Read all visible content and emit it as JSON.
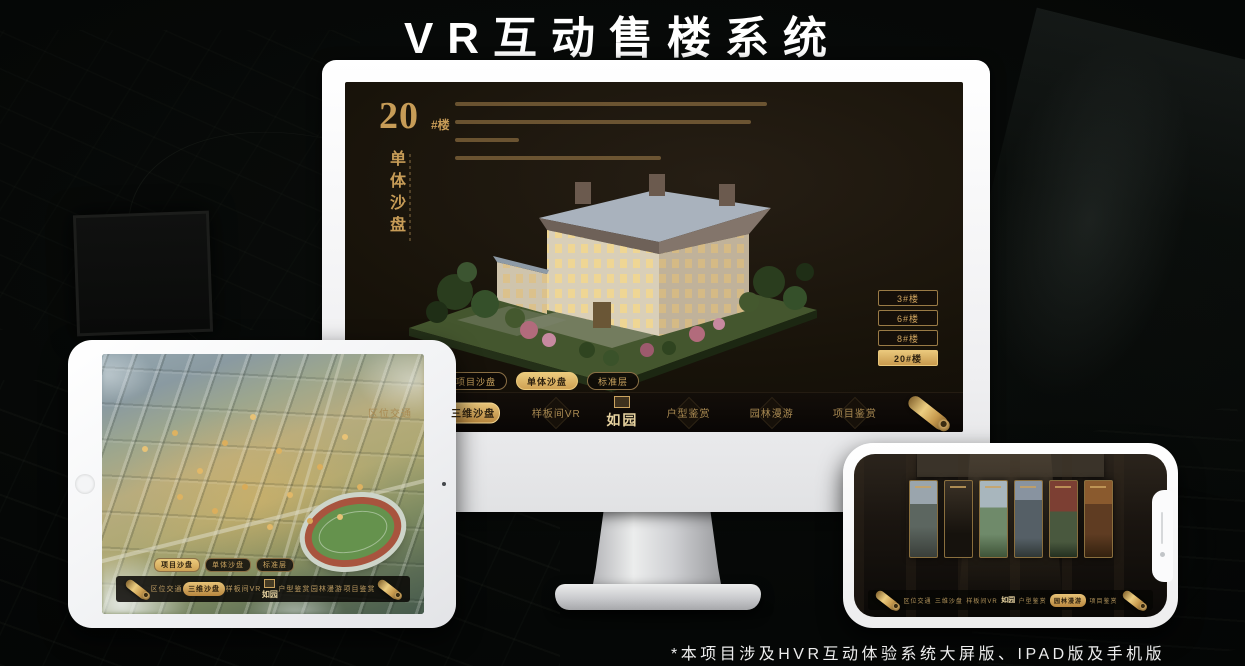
{
  "title": "VR互动售楼系统",
  "footnote": "*本项目涉及HVR互动体验系统大屏版、IPAD版及手机版",
  "colors": {
    "gold_accent": "#D8AC61",
    "gold_dim": "#A4834E",
    "screen_background": "#17120D",
    "active_tab_text": "#2B1F0E",
    "device_body": "#FFFFFF",
    "title_text": "#FFFFFF"
  },
  "nav": {
    "logo": "如园",
    "items": [
      {
        "label": "区位交通"
      },
      {
        "label": "三维沙盘",
        "active": true
      },
      {
        "label": "样板间VR"
      },
      {
        "label": "户型鉴赏"
      },
      {
        "label": "园林漫游"
      },
      {
        "label": "项目鉴赏"
      }
    ]
  },
  "monitor": {
    "panel": {
      "number": "20",
      "unit": "#楼",
      "subtitle": "单体沙盘"
    },
    "floor_buttons": [
      {
        "label": "3#楼",
        "active": false
      },
      {
        "label": "6#楼",
        "active": false
      },
      {
        "label": "8#楼",
        "active": false
      },
      {
        "label": "20#楼",
        "active": true
      }
    ],
    "sub_tabs": [
      {
        "label": "项目沙盘",
        "active": false
      },
      {
        "label": "单体沙盘",
        "active": true
      },
      {
        "label": "标准层",
        "active": false
      }
    ]
  },
  "ipad": {
    "sub_tabs": [
      {
        "label": "项目沙盘",
        "active": true
      },
      {
        "label": "单体沙盘",
        "active": false
      },
      {
        "label": "标准层",
        "active": false
      }
    ]
  }
}
